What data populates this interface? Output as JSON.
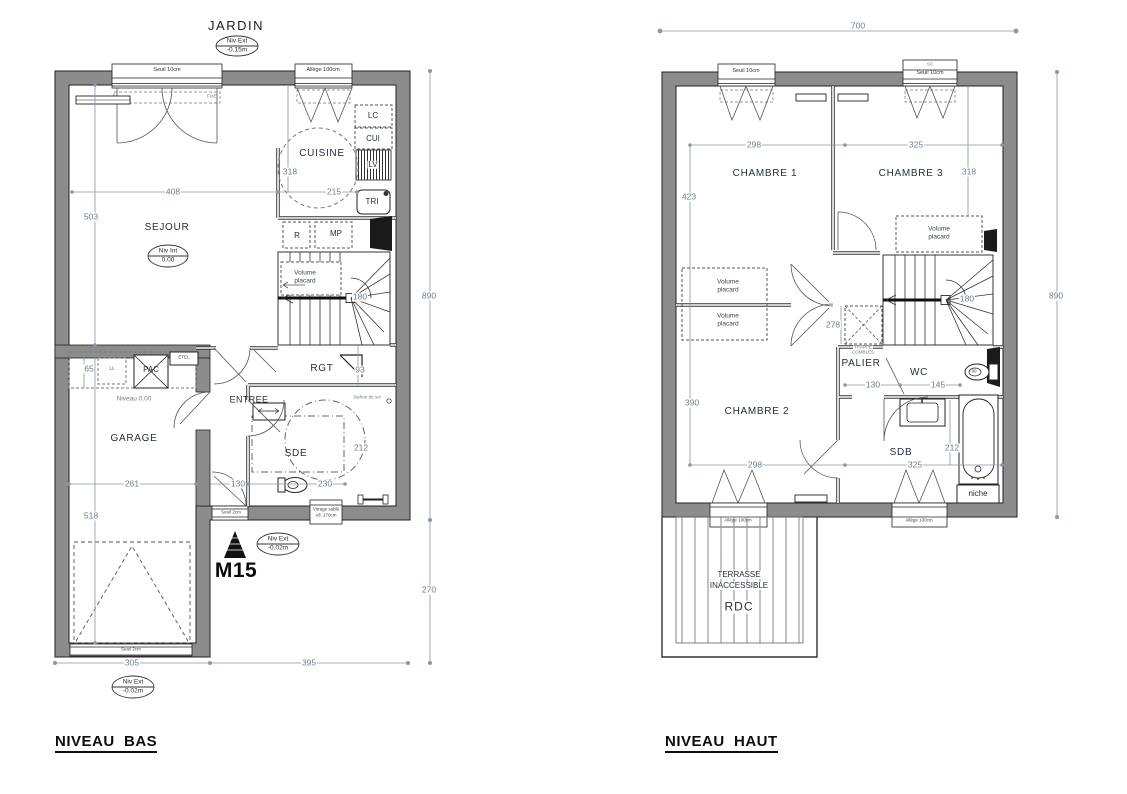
{
  "colors": {
    "wall_fill": "#8c8c8c",
    "outline": "#222222",
    "dim_line": "#8b97a6",
    "dim_text": "#6d7c8e",
    "room_text": "#252e3f",
    "black_fixture": "#141414"
  },
  "bas": {
    "title": "NIVEAU  BAS",
    "jardin": "JARDIN",
    "marker": "M15",
    "levels": {
      "ext_top_label": "Niv Ext",
      "ext_top_value": "-0.15m",
      "int_label": "Niv Int",
      "int_value": "0.00",
      "ext_mid_label": "Niv Ext",
      "ext_mid_value": "-0.02m",
      "ext_bot_label": "Niv Ext",
      "ext_bot_value": "-0.02m"
    },
    "rooms": {
      "sejour": "SEJOUR",
      "cuisine": "CUISINE",
      "garage": "GARAGE",
      "entree": "ENTREE",
      "sde": "SDE",
      "rgt": "RGT"
    },
    "fixtures": {
      "lc": "LC",
      "cui": "CUI",
      "lv": "LV",
      "tri": "TRI",
      "r": "R",
      "mp": "MP",
      "ll": "LL",
      "pac": "PAC",
      "etel": "ETEL",
      "volume_l1": "Volume",
      "volume_l2": "placard",
      "niveau": "Niveau 0.00",
      "siphon": "Siphon de sol"
    },
    "windows": {
      "seuil10": "Seuil 10cm",
      "allege100": "Allège 100cm",
      "fixe": "FIXE",
      "seuil2_entree": "Seuil 2cm",
      "seuil2_garage": "Seuil 2cm",
      "vitrage_l1": "Vitrage sablé",
      "vitrage_l2": "All. 170cm"
    },
    "dims": {
      "d503": "503",
      "d408": "408",
      "d318": "318",
      "d215": "215",
      "d890": "890",
      "d180": "180",
      "d93": "93",
      "d212": "212",
      "d130": "130",
      "d230": "230",
      "d65": "65",
      "d261": "261",
      "d518": "518",
      "d305": "305",
      "d395": "395",
      "d270": "270"
    }
  },
  "haut": {
    "title": "NIVEAU  HAUT",
    "rooms": {
      "chambre1": "CHAMBRE 1",
      "chambre2": "CHAMBRE 2",
      "chambre3": "CHAMBRE 3",
      "palier": "PALIER",
      "wc": "WC",
      "sdb": "SDB"
    },
    "labels": {
      "volume_l1": "Volume",
      "volume_l2": "placard",
      "trappe_l1": "TRAPPE",
      "trappe_l2": "COMBLES",
      "niche": "niche",
      "terrasse_l1": "TERRASSE",
      "terrasse_l2": "INACCESSIBLE",
      "terrasse_l3": "RDC",
      "sc": "SC"
    },
    "windows": {
      "seuil10": "Seuil 10cm",
      "allege100": "Allège 100cm"
    },
    "dims": {
      "d700": "700",
      "d890": "890",
      "d298a": "298",
      "d325a": "325",
      "d318": "318",
      "d423": "423",
      "d390": "390",
      "d298b": "298",
      "d325b": "325",
      "d180": "180",
      "d278": "278",
      "d130": "130",
      "d145": "145",
      "d90": "90",
      "d212": "212"
    }
  }
}
